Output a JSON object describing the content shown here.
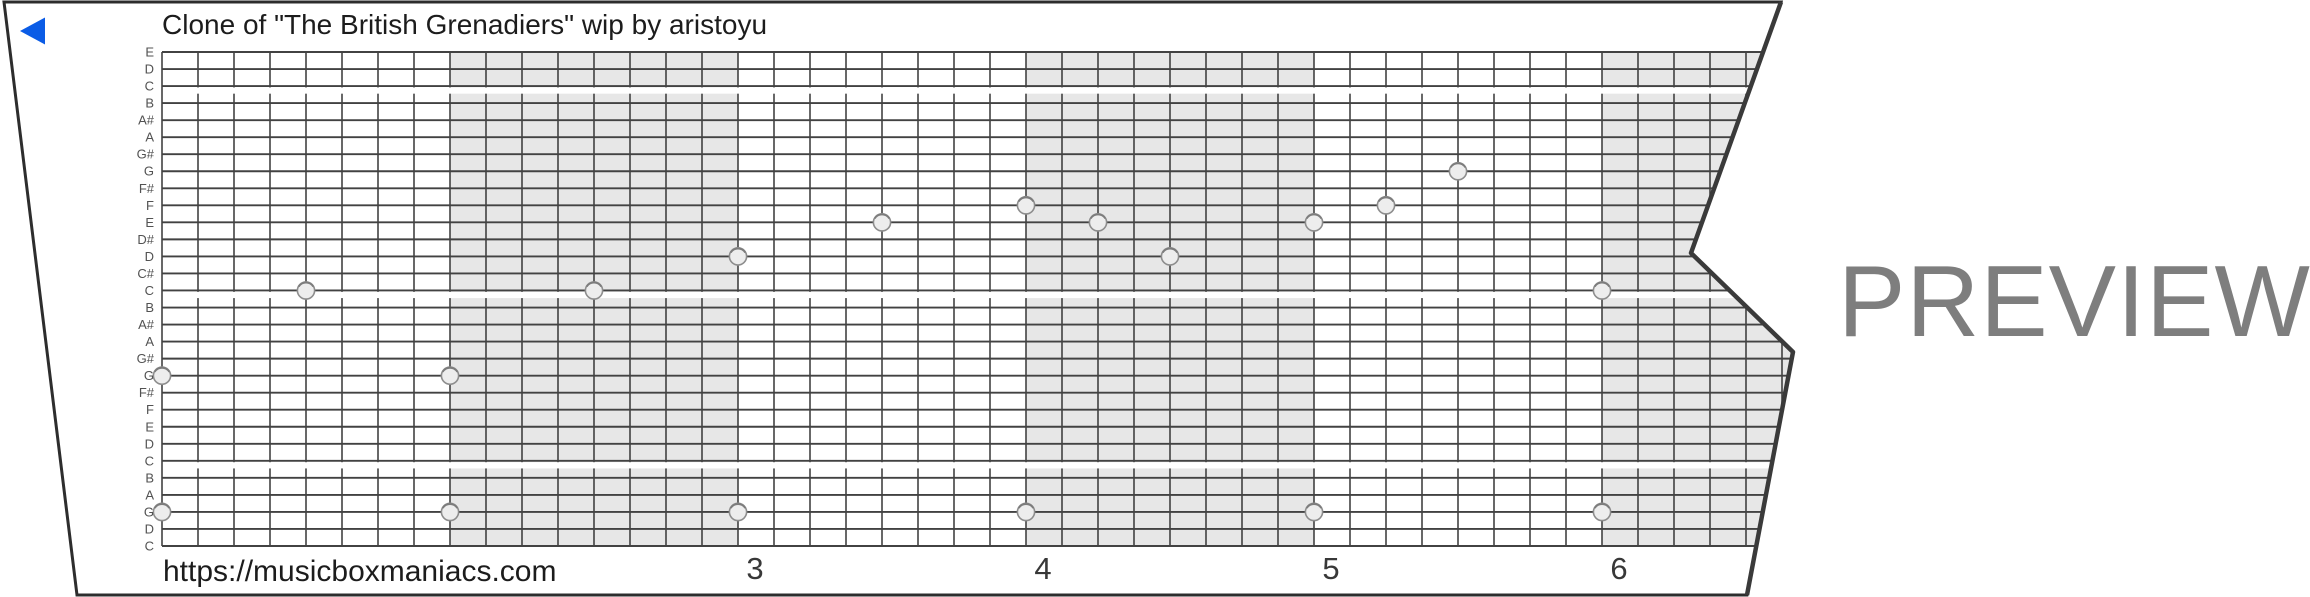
{
  "title": "Clone of \"The British Grenadiers\" wip by aristoyu",
  "watermark": "PREVIEW",
  "footer_url": "https://musicboxmaniacs.com",
  "play_button": {
    "icon": "triangle-left"
  },
  "note_labels": [
    "E",
    "D",
    "C",
    "B",
    "A#",
    "A",
    "G#",
    "G",
    "F#",
    "F",
    "E",
    "D#",
    "D",
    "C#",
    "C",
    "B",
    "A#",
    "A",
    "G#",
    "G",
    "F#",
    "F",
    "E",
    "D",
    "C",
    "B",
    "A",
    "G",
    "D",
    "C"
  ],
  "measure_numbers": [
    "3",
    "4",
    "5",
    "6"
  ],
  "first_numbered_measure": 3,
  "shaded_measures": [
    2,
    4,
    6
  ],
  "octave_gap_after_rows": [
    2,
    14,
    24
  ],
  "chart_data": {
    "type": "piano-roll",
    "title": "Clone of \"The British Grenadiers\" wip by aristoyu",
    "rows_top_to_bottom": [
      "E",
      "D",
      "C",
      "B",
      "A#",
      "A",
      "G#",
      "G",
      "F#",
      "F",
      "E",
      "D#",
      "D",
      "C#",
      "C",
      "B",
      "A#",
      "A",
      "G#",
      "G",
      "F#",
      "F",
      "E",
      "D",
      "C",
      "B",
      "A",
      "G",
      "D",
      "C"
    ],
    "cells_per_measure": 8,
    "visible_measures": 6,
    "notes": [
      {
        "cell": 0,
        "row": 19,
        "pitch": "G"
      },
      {
        "cell": 0,
        "row": 27,
        "pitch": "G bass"
      },
      {
        "cell": 4,
        "row": 14,
        "pitch": "C"
      },
      {
        "cell": 8,
        "row": 19,
        "pitch": "G"
      },
      {
        "cell": 8,
        "row": 27,
        "pitch": "G bass"
      },
      {
        "cell": 12,
        "row": 14,
        "pitch": "C"
      },
      {
        "cell": 16,
        "row": 12,
        "pitch": "D"
      },
      {
        "cell": 16,
        "row": 27,
        "pitch": "G bass"
      },
      {
        "cell": 20,
        "row": 10,
        "pitch": "E"
      },
      {
        "cell": 24,
        "row": 9,
        "pitch": "F"
      },
      {
        "cell": 24,
        "row": 27,
        "pitch": "G bass"
      },
      {
        "cell": 26,
        "row": 10,
        "pitch": "E"
      },
      {
        "cell": 28,
        "row": 12,
        "pitch": "D"
      },
      {
        "cell": 32,
        "row": 10,
        "pitch": "E"
      },
      {
        "cell": 32,
        "row": 27,
        "pitch": "G bass"
      },
      {
        "cell": 34,
        "row": 9,
        "pitch": "F"
      },
      {
        "cell": 36,
        "row": 7,
        "pitch": "G"
      },
      {
        "cell": 40,
        "row": 14,
        "pitch": "C"
      },
      {
        "cell": 40,
        "row": 27,
        "pitch": "G bass"
      }
    ]
  },
  "colors": {
    "grid_line": "#424242",
    "paper_border": "#2d2d2d",
    "tear_edge": "#3a3a3a",
    "measure_shade": "#e7e7e7",
    "hole_fill": "#ededed",
    "hole_stroke": "#8d8d8d",
    "note_label": "#525252",
    "text_ink": "#1c1c1c",
    "measure_number": "#383838",
    "watermark": "#7e7e7e",
    "play_blue": "#0b5ce6"
  }
}
